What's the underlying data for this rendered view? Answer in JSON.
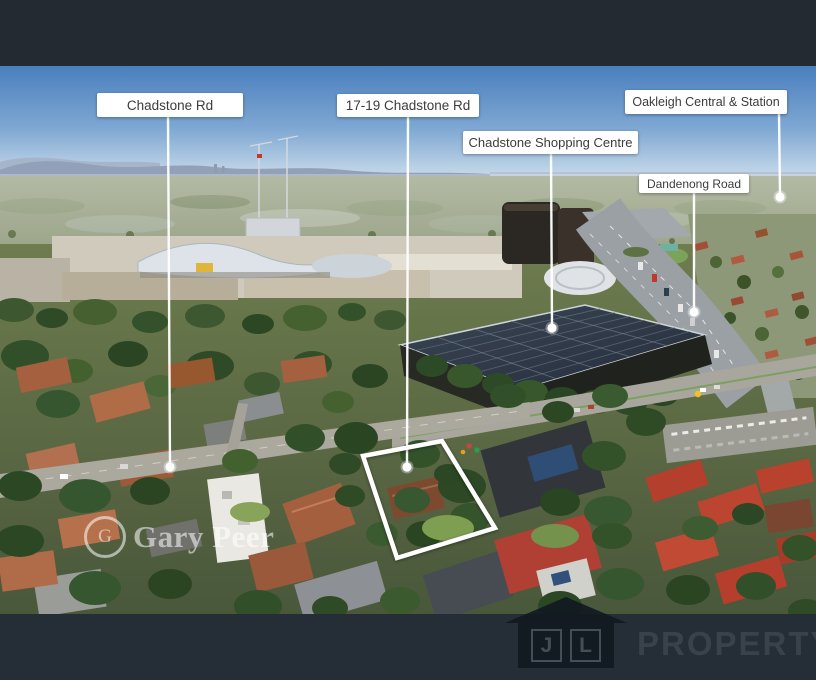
{
  "annotations": {
    "labels": [
      {
        "id": "chadstone-rd",
        "text": "Chadstone Rd"
      },
      {
        "id": "17-19-chadstone-rd",
        "text": "17-19 Chadstone Rd"
      },
      {
        "id": "oakleigh-central-station",
        "text": "Oakleigh Central & Station"
      },
      {
        "id": "chadstone-shopping-centre",
        "text": "Chadstone Shopping Centre"
      },
      {
        "id": "dandenong-road",
        "text": "Dandenong Road"
      }
    ],
    "property_boundary": {
      "shape": "quadrilateral",
      "stroke": "#ffffff"
    }
  },
  "watermarks": {
    "agency": {
      "name": "Gary Peer",
      "monogram": "G"
    },
    "brand": {
      "letter_1": "J",
      "letter_2": "L",
      "name": "PROPERTY"
    }
  },
  "colors": {
    "frame_bar": "#232a32",
    "label_background": "#ffffff",
    "label_text": "#3c3c3c",
    "callout": "#ffffff",
    "boundary": "#ffffff",
    "jl_watermark_text": "#39424c"
  }
}
